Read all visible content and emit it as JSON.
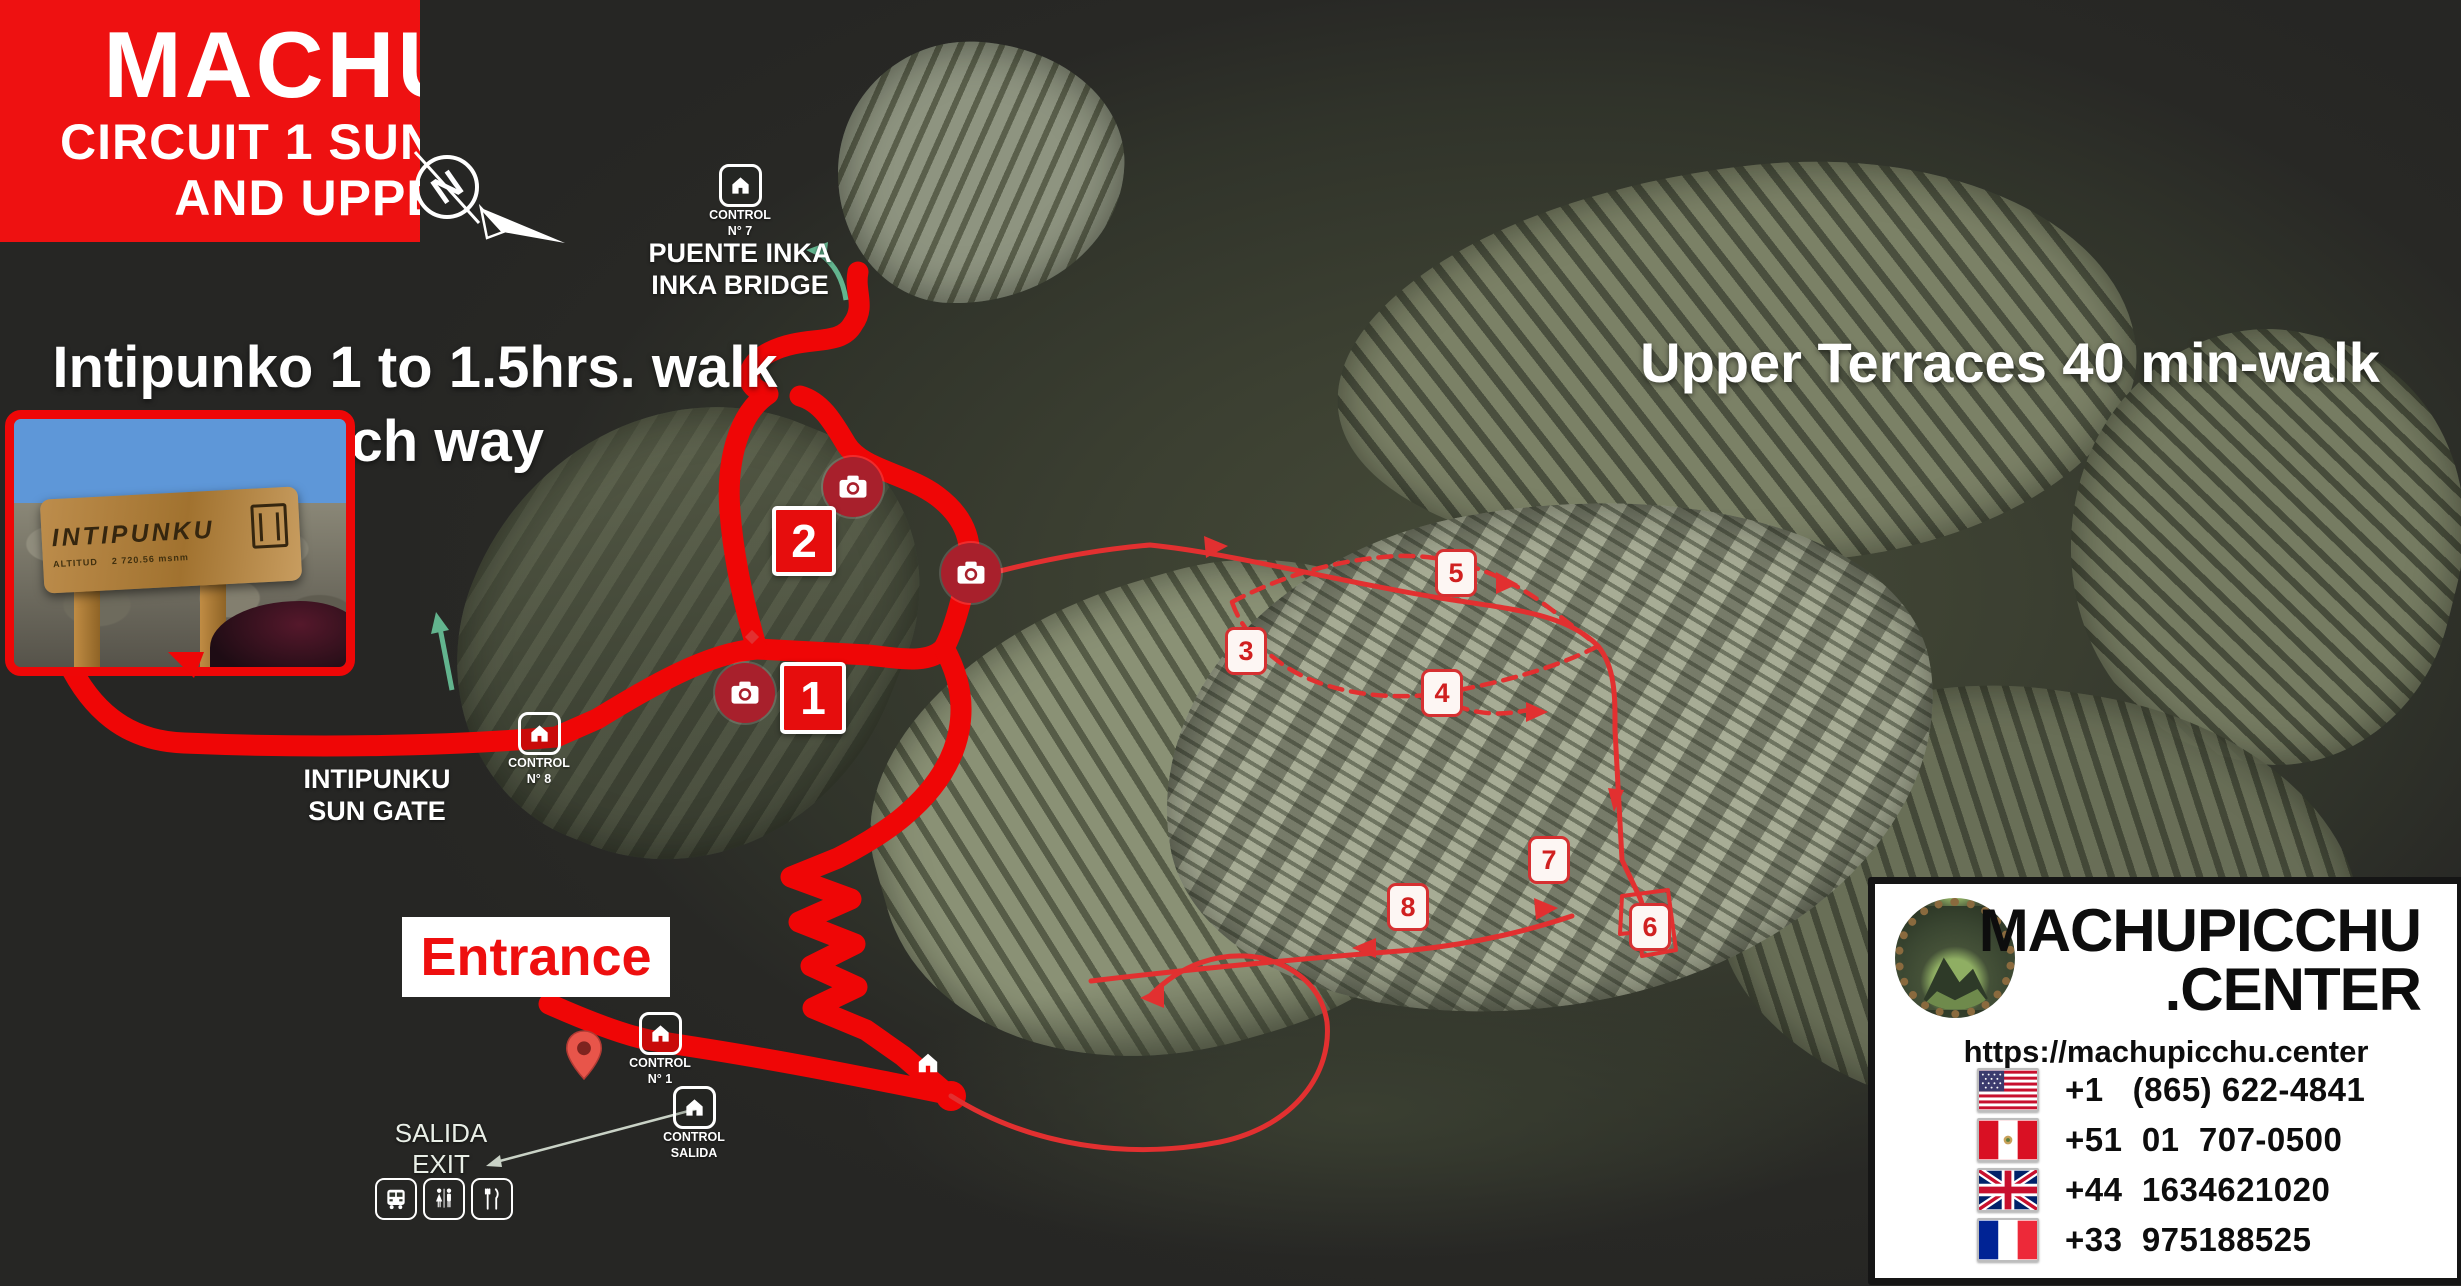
{
  "banner": {
    "line1": "MACHUPICCHU",
    "line2": "CIRCUIT 1 SUN GATE INTIPUNKO",
    "line3": "AND UPPER TERRACES"
  },
  "labels": {
    "intipunko_walk_line1": "Intipunko 1 to 1.5hrs. walk",
    "intipunko_walk_line2": "each way",
    "upper_terraces": "Upper Terraces 40 min-walk",
    "entrance": "Entrance",
    "sun_gate_line1": "INTIPUNKU",
    "sun_gate_line2": "SUN GATE",
    "bridge_line1": "PUENTE INKA",
    "bridge_line2": "INKA BRIDGE",
    "salida_line1": "SALIDA",
    "salida_line2": "EXIT",
    "compass_n": "N"
  },
  "controls": {
    "c7": {
      "l1": "CONTROL",
      "l2": "N° 7"
    },
    "c8": {
      "l1": "CONTROL",
      "l2": "N° 8"
    },
    "c1": {
      "l1": "CONTROL",
      "l2": "N° 1"
    },
    "salida": {
      "l1": "CONTROL",
      "l2": "SALIDA"
    }
  },
  "photo_inset": {
    "sign_title": "INTIPUNKU",
    "sign_alt_label": "ALTITUD",
    "sign_alt_value": "2 720.56 msnm"
  },
  "markers": {
    "primary": [
      "1",
      "2"
    ],
    "secondary": [
      "3",
      "4",
      "5",
      "6",
      "7",
      "8"
    ]
  },
  "footer": {
    "brand_line1": "MACHUPICCHU",
    "brand_line2": ".CENTER",
    "url": "https://machupicchu.center",
    "phones": [
      {
        "country": "usa",
        "number": "+1   (865) 622-4841"
      },
      {
        "country": "peru",
        "number": "+51  01  707-0500"
      },
      {
        "country": "uk",
        "number": "+44  1634621020"
      },
      {
        "country": "france",
        "number": "+33  975188525"
      }
    ]
  },
  "colors": {
    "banner_red": "#ee1111",
    "route_red": "#ef0606",
    "thin_route_red": "#e23030",
    "camera_maroon": "#a8202c",
    "entrance_red": "#ee0f0f",
    "green_arrow": "#62b48e"
  }
}
